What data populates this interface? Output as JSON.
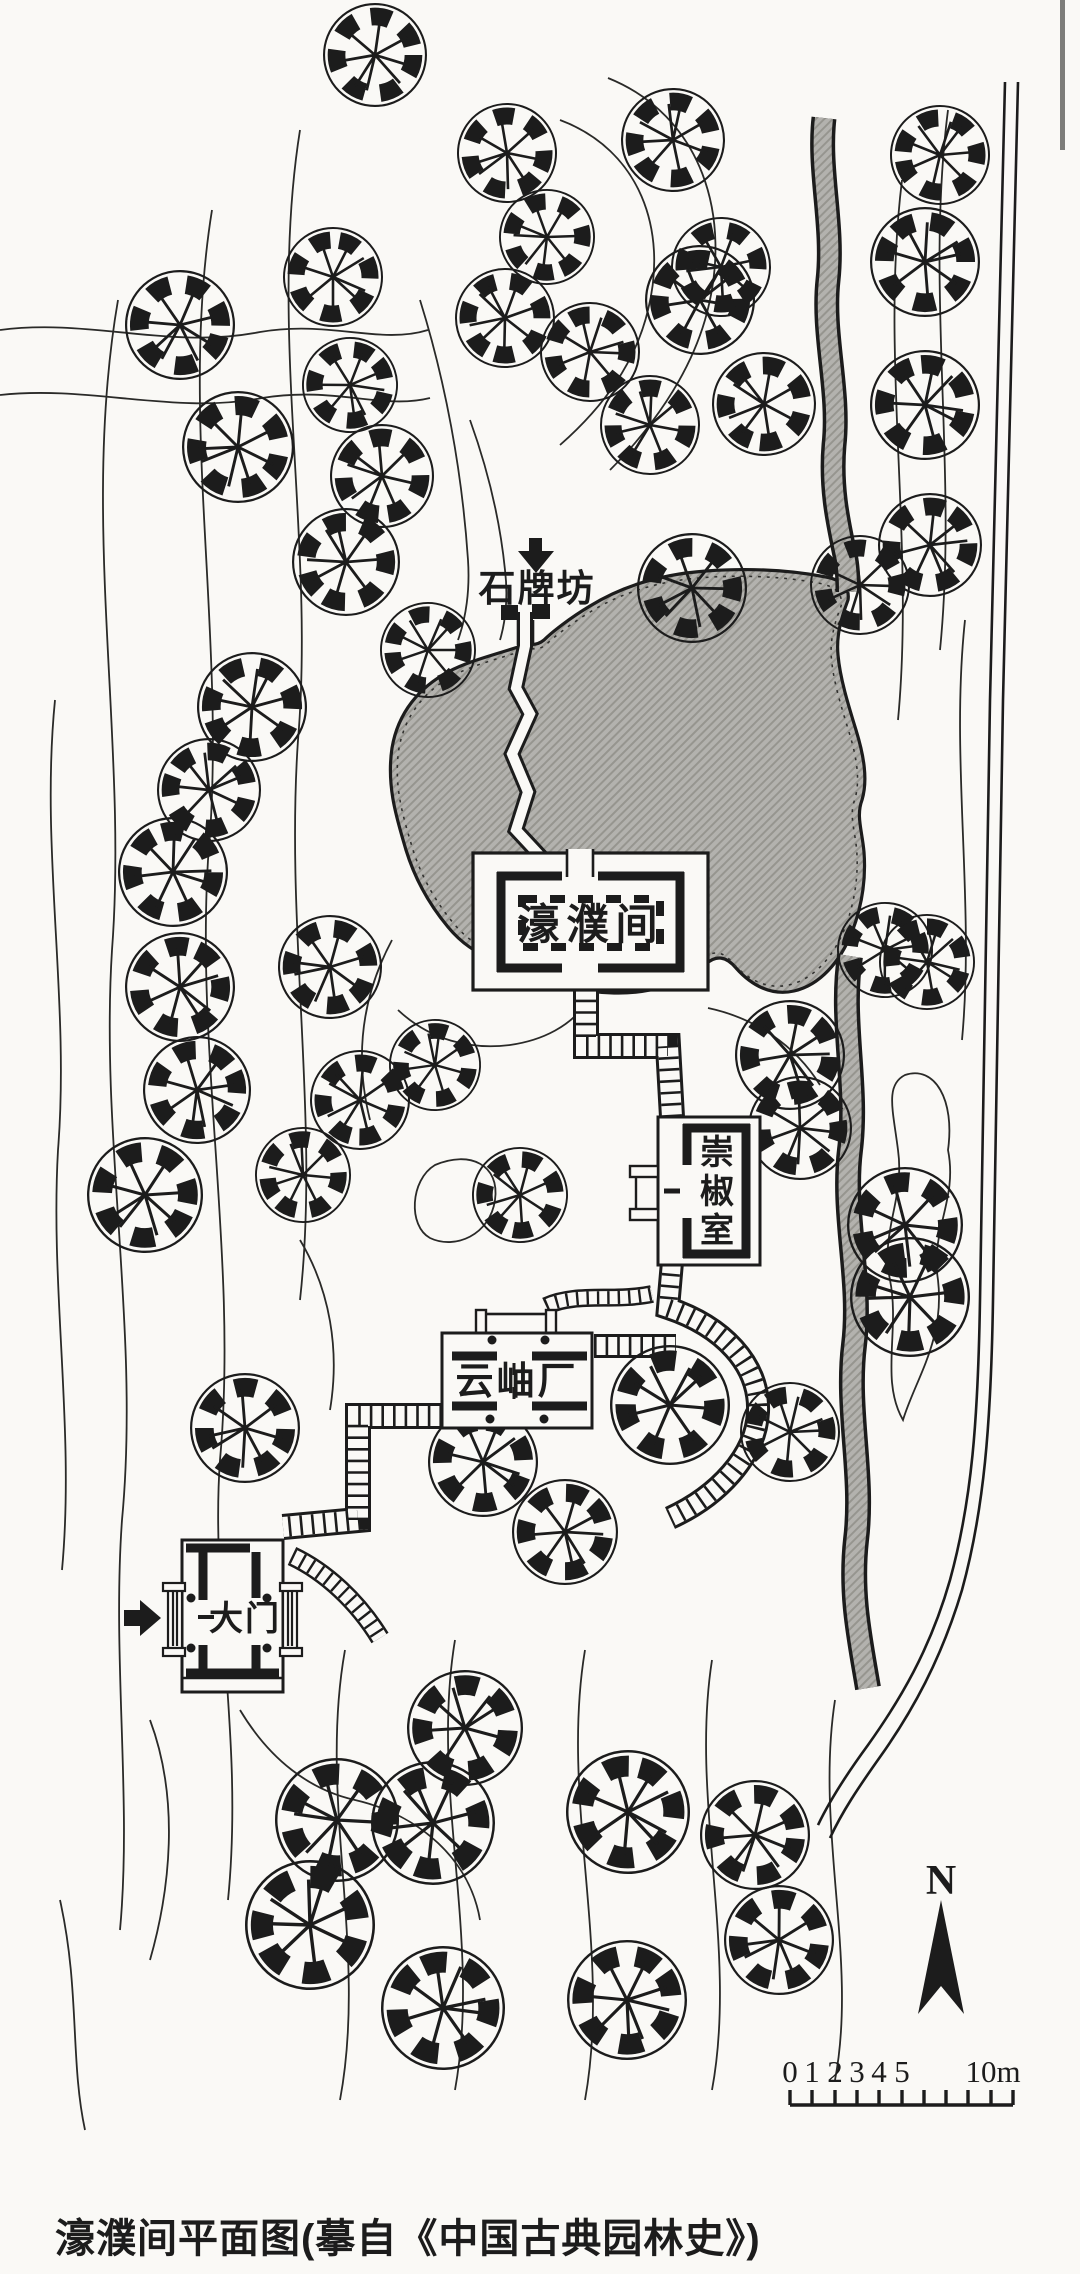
{
  "page": {
    "caption": "濠濮间平面图(摹自《中国古典园林史》)"
  },
  "labels": {
    "stone_archway": "石牌坊",
    "haopu_hall": "濠濮间",
    "chongjiao_chars": [
      "崇",
      "椒",
      "室"
    ],
    "yunxiu_hall": "云岫厂",
    "main_gate": "大门"
  },
  "compass": {
    "north": "N"
  },
  "scale_bar": {
    "ticks": [
      "0",
      "1",
      "2",
      "3",
      "4",
      "5"
    ],
    "end": "10m"
  },
  "colors": {
    "paper": "#faf9f6",
    "ink": "#1c1c1c",
    "water": "#b3b2ae",
    "water_hatch": "#96958f"
  }
}
